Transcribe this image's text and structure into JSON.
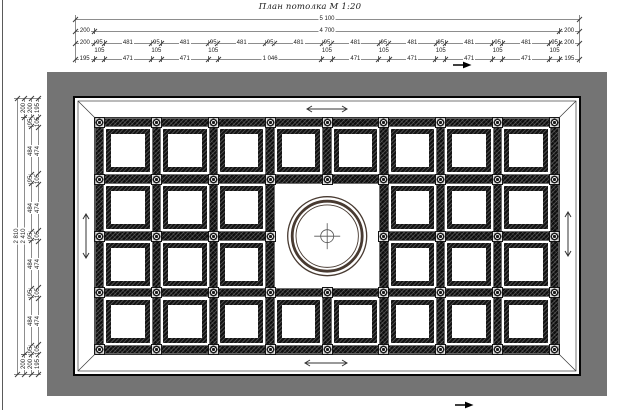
{
  "title": "План потолка М 1:20",
  "colors": {
    "canvas_bg": "#747474",
    "sheet_bg": "#ffffff",
    "beam": "#0e0e0e",
    "medallion_ring": "#483a31",
    "dim_line": "#8d8d8d",
    "dim_text": "#222222"
  },
  "icons": {
    "cursor_top": "right-arrow-cursor",
    "cursor_bottom": "right-arrow-cursor",
    "band_arrows": "double-headed-arrow"
  },
  "dimensions": {
    "top": {
      "rows": [
        {
          "segments": [
            {
              "v": 5103,
              "label": "5 100"
            }
          ]
        },
        {
          "segments": [
            {
              "v": 200,
              "label": "200"
            },
            {
              "v": 4703,
              "label": "4 700"
            },
            {
              "v": 200,
              "label": "200"
            }
          ]
        },
        {
          "segments": [
            {
              "v": 200,
              "label": "200"
            },
            {
              "v": 95,
              "label": "95"
            },
            {
              "v": 481,
              "label": "481"
            },
            {
              "v": 95,
              "label": "95"
            },
            {
              "v": 481,
              "label": "481"
            },
            {
              "v": 95,
              "label": "95"
            },
            {
              "v": 481,
              "label": "481"
            },
            {
              "v": 95,
              "label": "95"
            },
            {
              "v": 481,
              "label": "481"
            },
            {
              "v": 95,
              "label": "95"
            },
            {
              "v": 481,
              "label": "481"
            },
            {
              "v": 95,
              "label": "95"
            },
            {
              "v": 481,
              "label": "481"
            },
            {
              "v": 95,
              "label": "95"
            },
            {
              "v": 481,
              "label": "481"
            },
            {
              "v": 95,
              "label": "95"
            },
            {
              "v": 481,
              "label": "481"
            },
            {
              "v": 95,
              "label": "95"
            },
            {
              "v": 200,
              "label": "200"
            }
          ]
        },
        {
          "segments": [
            {
              "v": 195,
              "label": "195"
            },
            {
              "v": 105,
              "label": "105",
              "raise": true
            },
            {
              "v": 471,
              "label": "471"
            },
            {
              "v": 105,
              "label": "105",
              "raise": true
            },
            {
              "v": 471,
              "label": "471"
            },
            {
              "v": 105,
              "label": "105",
              "raise": true
            },
            {
              "v": 1046,
              "label": "1 046"
            },
            {
              "v": 105,
              "label": "105",
              "raise": true
            },
            {
              "v": 471,
              "label": "471"
            },
            {
              "v": 105,
              "label": "105",
              "raise": true
            },
            {
              "v": 471,
              "label": "471"
            },
            {
              "v": 105,
              "label": "105",
              "raise": true
            },
            {
              "v": 471,
              "label": "471"
            },
            {
              "v": 105,
              "label": "105",
              "raise": true
            },
            {
              "v": 471,
              "label": "471"
            },
            {
              "v": 105,
              "label": "105",
              "raise": true
            },
            {
              "v": 195,
              "label": "195"
            }
          ]
        }
      ]
    },
    "left": {
      "cols": [
        {
          "segments": [
            {
              "v": 2811,
              "label": "2 810"
            }
          ]
        },
        {
          "segments": [
            {
              "v": 200,
              "label": "200"
            },
            {
              "v": 2411,
              "label": "2 410"
            },
            {
              "v": 200,
              "label": "200"
            }
          ]
        },
        {
          "segments": [
            {
              "v": 200,
              "label": "200"
            },
            {
              "v": 95,
              "label": "95"
            },
            {
              "v": 484,
              "label": "484"
            },
            {
              "v": 95,
              "label": "95"
            },
            {
              "v": 484,
              "label": "484"
            },
            {
              "v": 95,
              "label": "95"
            },
            {
              "v": 484,
              "label": "484"
            },
            {
              "v": 95,
              "label": "95"
            },
            {
              "v": 484,
              "label": "484"
            },
            {
              "v": 95,
              "label": "95"
            },
            {
              "v": 200,
              "label": "200"
            }
          ]
        },
        {
          "segments": [
            {
              "v": 195,
              "label": "195"
            },
            {
              "v": 105,
              "label": "105"
            },
            {
              "v": 474,
              "label": "474"
            },
            {
              "v": 105,
              "label": "105"
            },
            {
              "v": 474,
              "label": "474"
            },
            {
              "v": 105,
              "label": "105"
            },
            {
              "v": 474,
              "label": "474"
            },
            {
              "v": 105,
              "label": "105"
            },
            {
              "v": 474,
              "label": "474"
            },
            {
              "v": 105,
              "label": "105"
            },
            {
              "v": 195,
              "label": "195"
            }
          ]
        }
      ]
    }
  },
  "plan": {
    "h_seq": [
      200,
      95,
      481,
      95,
      481,
      95,
      481,
      95,
      481,
      95,
      481,
      95,
      481,
      95,
      481,
      95,
      481,
      95,
      200
    ],
    "v_seq": [
      200,
      95,
      484,
      95,
      484,
      95,
      484,
      95,
      484,
      95,
      200
    ],
    "medallion": {
      "col_start": 3,
      "col_end": 4,
      "row_start": 1,
      "row_end": 2
    }
  }
}
